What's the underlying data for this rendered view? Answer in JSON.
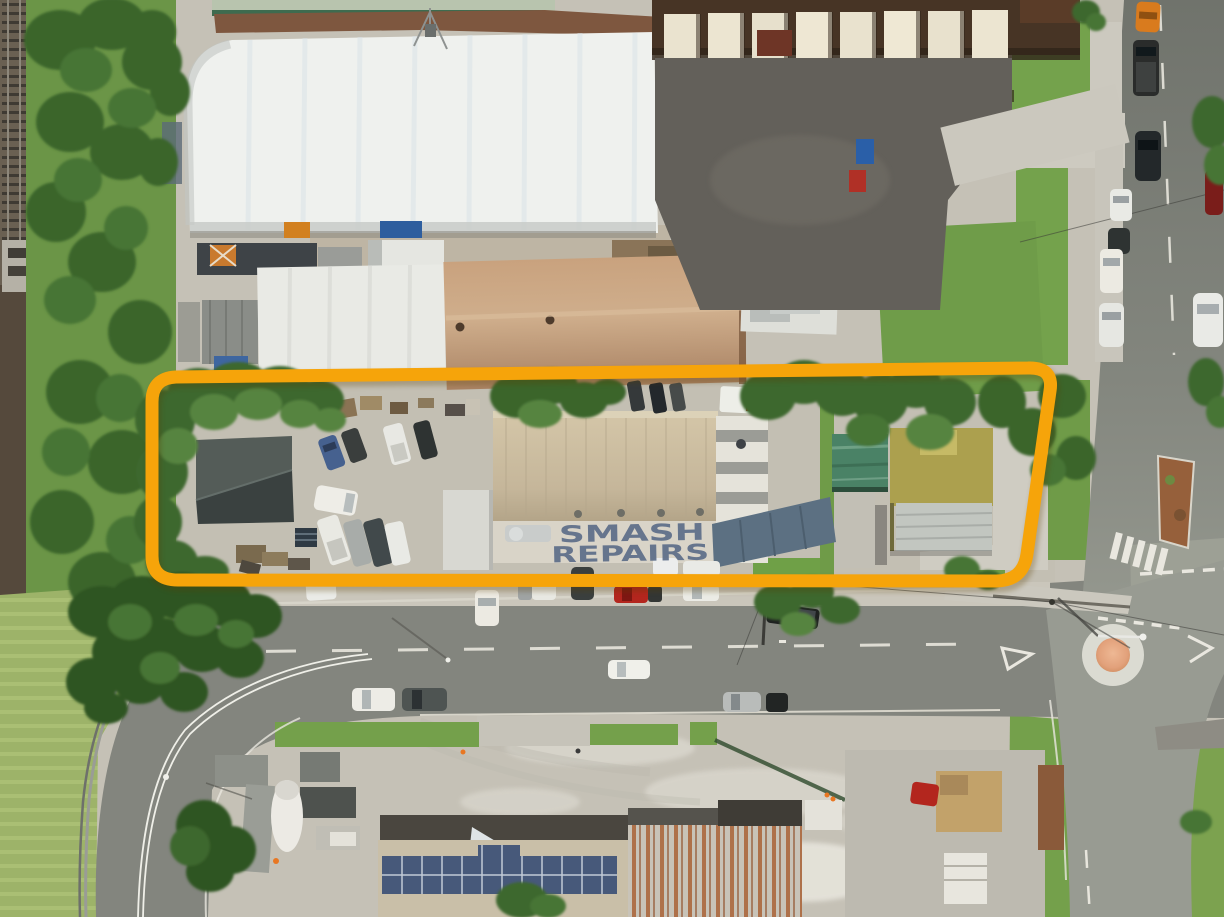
{
  "image": {
    "type": "aerial-drone-photograph",
    "subject": "Industrial smash repairs property outlined with an orange boundary, streets, warehouses and yards around it"
  },
  "sign": {
    "line1": "SMASH",
    "line2": "REPAIRS",
    "color": "#5d6d89"
  },
  "boundary": {
    "color": "#f6a40a"
  },
  "palette": {
    "grass": "#6f9c49",
    "trees": "#3d682f",
    "asphalt": "#85877f",
    "concrete": "#c5c1b6",
    "warehouse_roof": "#eff1ee",
    "tan_factory_roof": "#bd9878",
    "smash_building_roof": "#c5b69a",
    "blue_annex_roof": "#5c7082",
    "green_shed_roof": "#4a8266",
    "olive_roof": "#aca04e",
    "rust_roof_streaks": "#a85c2e",
    "solar_panels": "#47597a",
    "roundabout_center": "#e2a17b"
  }
}
